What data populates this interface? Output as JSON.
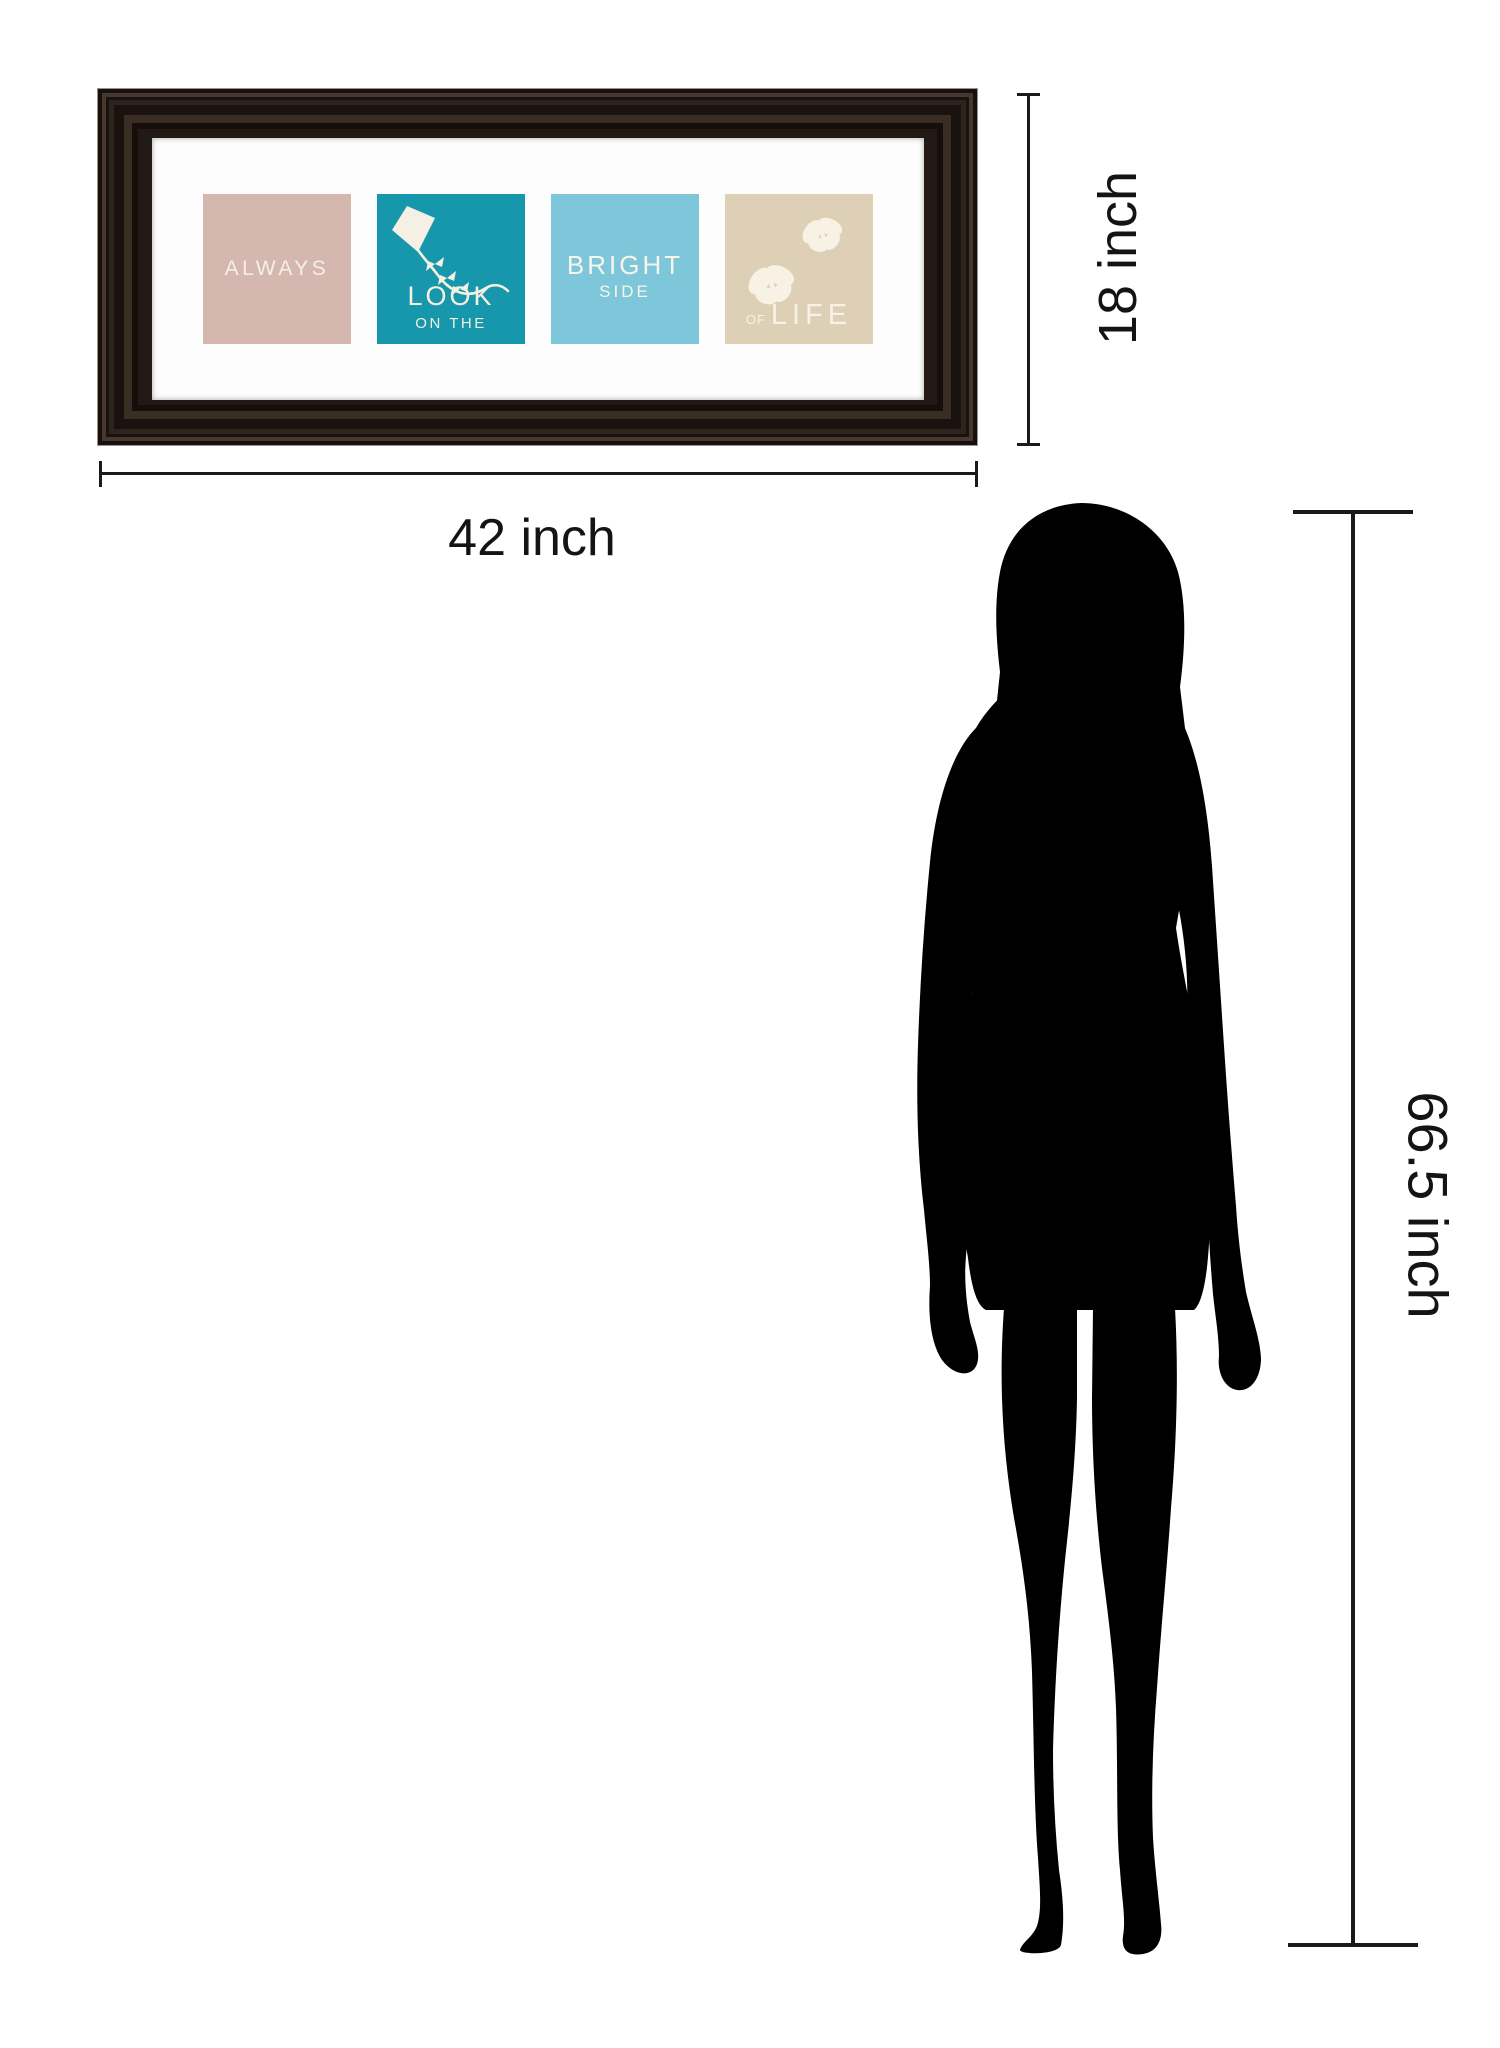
{
  "artwork": {
    "frame_color": "#231a15",
    "mat_color": "#fdfdfd",
    "panels": [
      {
        "id": "always",
        "bg": "#d4b8b0",
        "text_color": "#f6efe3",
        "line1": "ALWAYS"
      },
      {
        "id": "look-on-the",
        "bg": "#1697ab",
        "text_color": "#f6efe3",
        "icon": "kite-icon",
        "line1": "LOOK",
        "line2": "ON THE"
      },
      {
        "id": "bright-side",
        "bg": "#7ec6d9",
        "text_color": "#f8f5ea",
        "line1": "BRIGHT",
        "line2": "SIDE"
      },
      {
        "id": "of-life",
        "bg": "#ddd0b7",
        "text_color": "#f7f2e3",
        "icon": "butterflies-icon",
        "line_small": "OF",
        "line1": "LIFE"
      }
    ]
  },
  "dimensions": {
    "width": {
      "label": "42 inch"
    },
    "height": {
      "label": "18 inch"
    },
    "person": {
      "label": "66.5 inch"
    }
  },
  "silhouette": {
    "name": "woman-silhouette",
    "color": "#000000"
  },
  "colors": {
    "dimension_line": "#1a1a1a",
    "label_text": "#141414",
    "background": "#ffffff"
  }
}
